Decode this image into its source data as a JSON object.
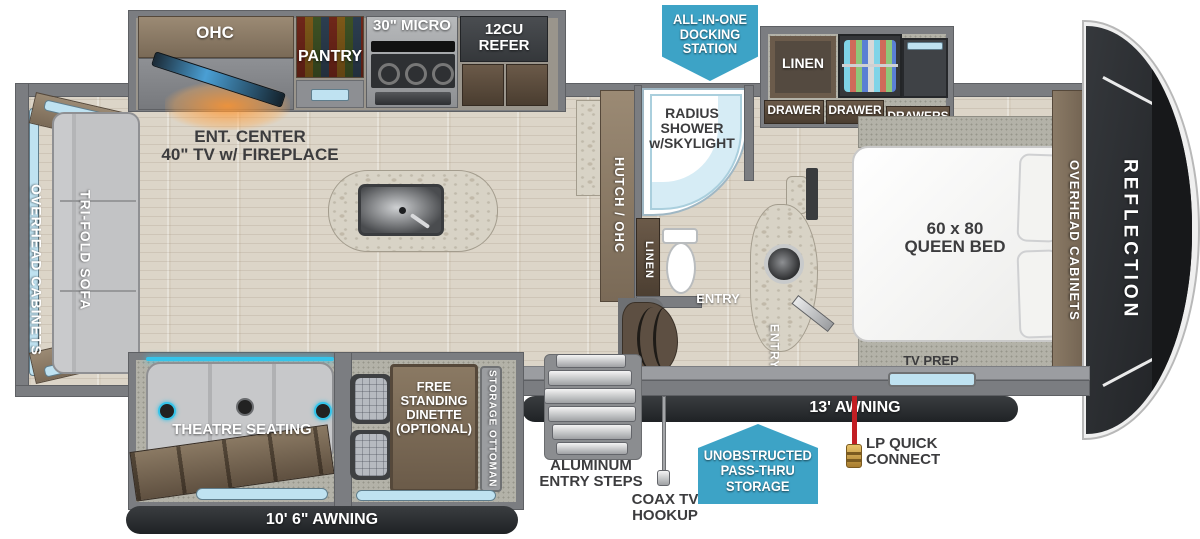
{
  "brand": "REFLECTION",
  "colors": {
    "callout_blue": "#3da3c6",
    "lp_red": "#c21f24",
    "awning_dark": "#2c2e31",
    "window_blue": "#bfe2f1",
    "accent_glow": "#35c4ea"
  },
  "rear": {
    "overhead_cabinets": "OVERHEAD CABINETS",
    "sofa": "TRI-FOLD SOFA",
    "awning": "10' 6\" AWNING"
  },
  "living": {
    "ent_center": "ENT. CENTER\n40\" TV w/ FIREPLACE",
    "theatre": "THEATRE SEATING",
    "dinette": "FREE\nSTANDING\nDINETTE\n(OPTIONAL)",
    "ottoman": "STORAGE OTTOMAN"
  },
  "kitchen": {
    "ohc": "OHC",
    "pantry": "PANTRY",
    "micro": "30\" MICRO",
    "refer": "12CU\nREFER",
    "hutch": "HUTCH / OHC"
  },
  "bath": {
    "shower": "RADIUS\nSHOWER\nw/SKYLIGHT",
    "linen": "LINEN",
    "entry": "ENTRY"
  },
  "bedroom": {
    "linen": "LINEN",
    "drawer_left": "DRAWER",
    "drawer_mid": "DRAWER",
    "drawers": "DRAWERS",
    "bed": "60 x 80\nQUEEN BED",
    "entry": "ENTRY",
    "overhead_cabinets": "OVERHEAD CABINETS",
    "tv_prep": "TV PREP"
  },
  "exterior": {
    "docking": "ALL-IN-ONE\nDOCKING\nSTATION",
    "awning_main": "13' AWNING",
    "steps": "ALUMINUM\nENTRY STEPS",
    "coax": "COAX TV\nHOOKUP",
    "passthru": "UNOBSTRUCTED\nPASS-THRU\nSTORAGE",
    "lp": "LP QUICK\nCONNECT"
  }
}
